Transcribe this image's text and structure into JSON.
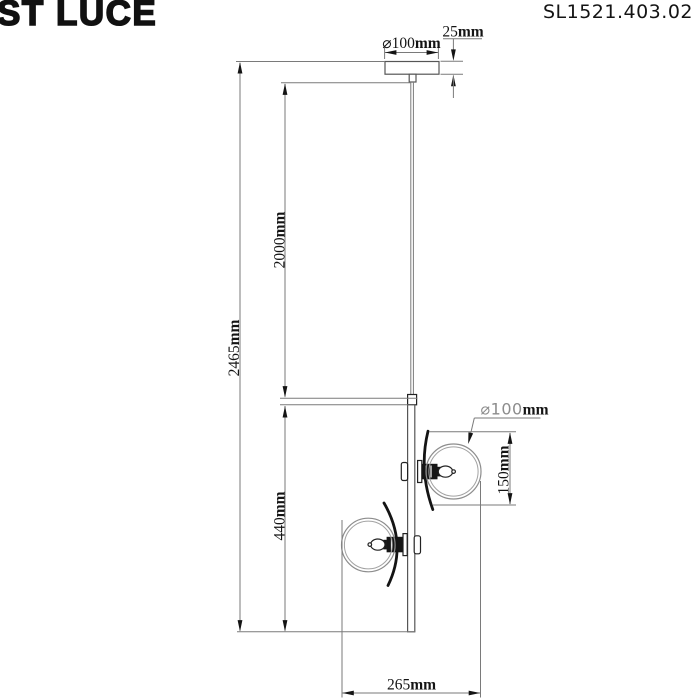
{
  "header": {
    "brand": "ST LUCE",
    "model": "SL1521.403.02"
  },
  "dimensions": {
    "canopy_diameter": {
      "value": "⌀100",
      "unit": "mm"
    },
    "canopy_height": {
      "value": "25",
      "unit": "mm"
    },
    "cable_length": {
      "value": "2000",
      "unit": "mm"
    },
    "total_height": {
      "value": "2465",
      "unit": "mm"
    },
    "body_height": {
      "value": "440",
      "unit": "mm"
    },
    "shade_diameter": {
      "value": "⌀100",
      "unit": "mm"
    },
    "shade_height": {
      "value": "150",
      "unit": "mm"
    },
    "overall_width": {
      "value": "265",
      "unit": "mm"
    }
  },
  "colors": {
    "ink": "#141414",
    "construction_line": "#7a7a7a",
    "object_line": "#565656",
    "sphere_outline": "#8d8d8d",
    "background": "#ffffff"
  }
}
